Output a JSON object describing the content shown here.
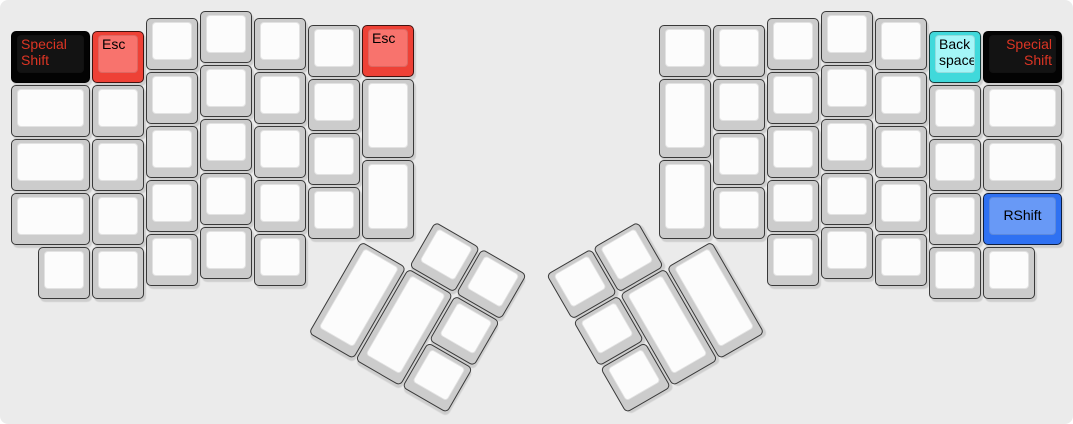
{
  "canvas": {
    "width_px": 1073,
    "height_px": 424,
    "background": "#ebebeb"
  },
  "layout": {
    "unit_px": 54,
    "main_origin_px": {
      "x": 10,
      "y": 10
    },
    "thumb_clusters": {
      "left": {
        "center_px": {
          "x": 361,
          "y": 240
        },
        "rotation_deg": 30
      },
      "right": {
        "center_px": {
          "x": 712,
          "y": 240
        },
        "rotation_deg": -30
      }
    }
  },
  "palette": {
    "white": {
      "side": "#cccccc",
      "top": "#fcfcfc",
      "text": "#111111"
    },
    "red": {
      "side": "#ee4136",
      "top": "#f8736d",
      "text": "#000000"
    },
    "cyan": {
      "side": "#40d9db",
      "top": "#a4f6f8",
      "text": "#000000"
    },
    "blue": {
      "side": "#2f71f2",
      "top": "#6899f6",
      "text": "#000000"
    },
    "black": {
      "side": "#030303",
      "top": "#131313",
      "text": "#dc3524"
    }
  },
  "legends": {
    "special_shift": "Special Shift",
    "esc": "Esc",
    "backspace": "Back space",
    "rshift": "RShift"
  },
  "keys": {
    "left_main": [
      [
        0,
        0.375,
        1.5,
        1,
        "black",
        "Special Shift",
        "tl"
      ],
      [
        1.5,
        0.375,
        1,
        1,
        "red",
        "Esc",
        "tl"
      ],
      [
        2.5,
        0.125,
        1,
        1,
        "white",
        "",
        "tl"
      ],
      [
        3.5,
        0,
        1,
        1,
        "white",
        "",
        "tl"
      ],
      [
        4.5,
        0.125,
        1,
        1,
        "white",
        "",
        "tl"
      ],
      [
        5.5,
        0.25,
        1,
        1,
        "white",
        "",
        "tl"
      ],
      [
        6.5,
        0.25,
        1,
        1,
        "red",
        "Esc",
        "tl"
      ],
      [
        0,
        1.375,
        1.5,
        1,
        "white",
        "",
        "tl"
      ],
      [
        1.5,
        1.375,
        1,
        1,
        "white",
        "",
        "tl"
      ],
      [
        2.5,
        1.125,
        1,
        1,
        "white",
        "",
        "tl"
      ],
      [
        3.5,
        1,
        1,
        1,
        "white",
        "",
        "tl"
      ],
      [
        4.5,
        1.125,
        1,
        1,
        "white",
        "",
        "tl"
      ],
      [
        5.5,
        1.25,
        1,
        1,
        "white",
        "",
        "tl"
      ],
      [
        6.5,
        1.25,
        1,
        1.5,
        "white",
        "",
        "tl"
      ],
      [
        0,
        2.375,
        1.5,
        1,
        "white",
        "",
        "tl"
      ],
      [
        1.5,
        2.375,
        1,
        1,
        "white",
        "",
        "tl"
      ],
      [
        2.5,
        2.125,
        1,
        1,
        "white",
        "",
        "tl"
      ],
      [
        3.5,
        2,
        1,
        1,
        "white",
        "",
        "tl"
      ],
      [
        4.5,
        2.125,
        1,
        1,
        "white",
        "",
        "tl"
      ],
      [
        5.5,
        2.25,
        1,
        1,
        "white",
        "",
        "tl"
      ],
      [
        6.5,
        2.75,
        1,
        1.5,
        "white",
        "",
        "tl"
      ],
      [
        0,
        3.375,
        1.5,
        1,
        "white",
        "",
        "tl"
      ],
      [
        1.5,
        3.375,
        1,
        1,
        "white",
        "",
        "tl"
      ],
      [
        2.5,
        3.125,
        1,
        1,
        "white",
        "",
        "tl"
      ],
      [
        3.5,
        3,
        1,
        1,
        "white",
        "",
        "tl"
      ],
      [
        4.5,
        3.125,
        1,
        1,
        "white",
        "",
        "tl"
      ],
      [
        5.5,
        3.25,
        1,
        1,
        "white",
        "",
        "tl"
      ],
      [
        0.5,
        4.375,
        1,
        1,
        "white",
        "",
        "tl"
      ],
      [
        1.5,
        4.375,
        1,
        1,
        "white",
        "",
        "tl"
      ],
      [
        2.5,
        4.125,
        1,
        1,
        "white",
        "",
        "tl"
      ],
      [
        3.5,
        4,
        1,
        1,
        "white",
        "",
        "tl"
      ],
      [
        4.5,
        4.125,
        1,
        1,
        "white",
        "",
        "tl"
      ]
    ],
    "right_main": [
      [
        12,
        0.25,
        1,
        1,
        "white",
        "",
        "tl"
      ],
      [
        13,
        0.25,
        1,
        1,
        "white",
        "",
        "tl"
      ],
      [
        14,
        0.125,
        1,
        1,
        "white",
        "",
        "tl"
      ],
      [
        15,
        0,
        1,
        1,
        "white",
        "",
        "tl"
      ],
      [
        16,
        0.125,
        1,
        1,
        "white",
        "",
        "tl"
      ],
      [
        17,
        0.375,
        1,
        1,
        "cyan",
        "Back space",
        "tl"
      ],
      [
        18,
        0.375,
        1.5,
        1,
        "black",
        "Special Shift",
        "tr"
      ],
      [
        12,
        1.25,
        1,
        1.5,
        "white",
        "",
        "tl"
      ],
      [
        13,
        1.25,
        1,
        1,
        "white",
        "",
        "tl"
      ],
      [
        14,
        1.125,
        1,
        1,
        "white",
        "",
        "tl"
      ],
      [
        15,
        1,
        1,
        1,
        "white",
        "",
        "tl"
      ],
      [
        16,
        1.125,
        1,
        1,
        "white",
        "",
        "tl"
      ],
      [
        17,
        1.375,
        1,
        1,
        "white",
        "",
        "tl"
      ],
      [
        18,
        1.375,
        1.5,
        1,
        "white",
        "",
        "tl"
      ],
      [
        12,
        2.75,
        1,
        1.5,
        "white",
        "",
        "tl"
      ],
      [
        13,
        2.25,
        1,
        1,
        "white",
        "",
        "tl"
      ],
      [
        14,
        2.125,
        1,
        1,
        "white",
        "",
        "tl"
      ],
      [
        15,
        2,
        1,
        1,
        "white",
        "",
        "tl"
      ],
      [
        16,
        2.125,
        1,
        1,
        "white",
        "",
        "tl"
      ],
      [
        17,
        2.375,
        1,
        1,
        "white",
        "",
        "tl"
      ],
      [
        18,
        2.375,
        1.5,
        1,
        "white",
        "",
        "tl"
      ],
      [
        13,
        3.25,
        1,
        1,
        "white",
        "",
        "tl"
      ],
      [
        14,
        3.125,
        1,
        1,
        "white",
        "",
        "tl"
      ],
      [
        15,
        3,
        1,
        1,
        "white",
        "",
        "tl"
      ],
      [
        16,
        3.125,
        1,
        1,
        "white",
        "",
        "tl"
      ],
      [
        17,
        3.375,
        1,
        1,
        "white",
        "",
        "tl"
      ],
      [
        18,
        3.375,
        1.5,
        1,
        "blue",
        "RShift",
        "c"
      ],
      [
        14,
        4.125,
        1,
        1,
        "white",
        "",
        "tl"
      ],
      [
        15,
        4,
        1,
        1,
        "white",
        "",
        "tl"
      ],
      [
        16,
        4.125,
        1,
        1,
        "white",
        "",
        "tl"
      ],
      [
        17,
        4.375,
        1,
        1,
        "white",
        "",
        "tl"
      ],
      [
        18,
        4.375,
        1,
        1,
        "white",
        "",
        "tl"
      ]
    ],
    "left_thumb": [
      [
        1,
        -1,
        1,
        1,
        "white",
        "",
        "tl"
      ],
      [
        2,
        -1,
        1,
        1,
        "white",
        "",
        "tl"
      ],
      [
        0,
        0,
        1,
        2,
        "white",
        "",
        "tl"
      ],
      [
        1,
        0,
        1,
        2,
        "white",
        "",
        "tl"
      ],
      [
        2,
        0,
        1,
        1,
        "white",
        "",
        "tl"
      ],
      [
        2,
        1,
        1,
        1,
        "white",
        "",
        "tl"
      ]
    ],
    "right_thumb": [
      [
        -3,
        -1,
        1,
        1,
        "white",
        "",
        "tl"
      ],
      [
        -2,
        -1,
        1,
        1,
        "white",
        "",
        "tl"
      ],
      [
        -3,
        0,
        1,
        1,
        "white",
        "",
        "tl"
      ],
      [
        -2,
        0,
        1,
        2,
        "white",
        "",
        "tl"
      ],
      [
        -1,
        0,
        1,
        2,
        "white",
        "",
        "tl"
      ],
      [
        -3,
        1,
        1,
        1,
        "white",
        "",
        "tl"
      ]
    ]
  }
}
